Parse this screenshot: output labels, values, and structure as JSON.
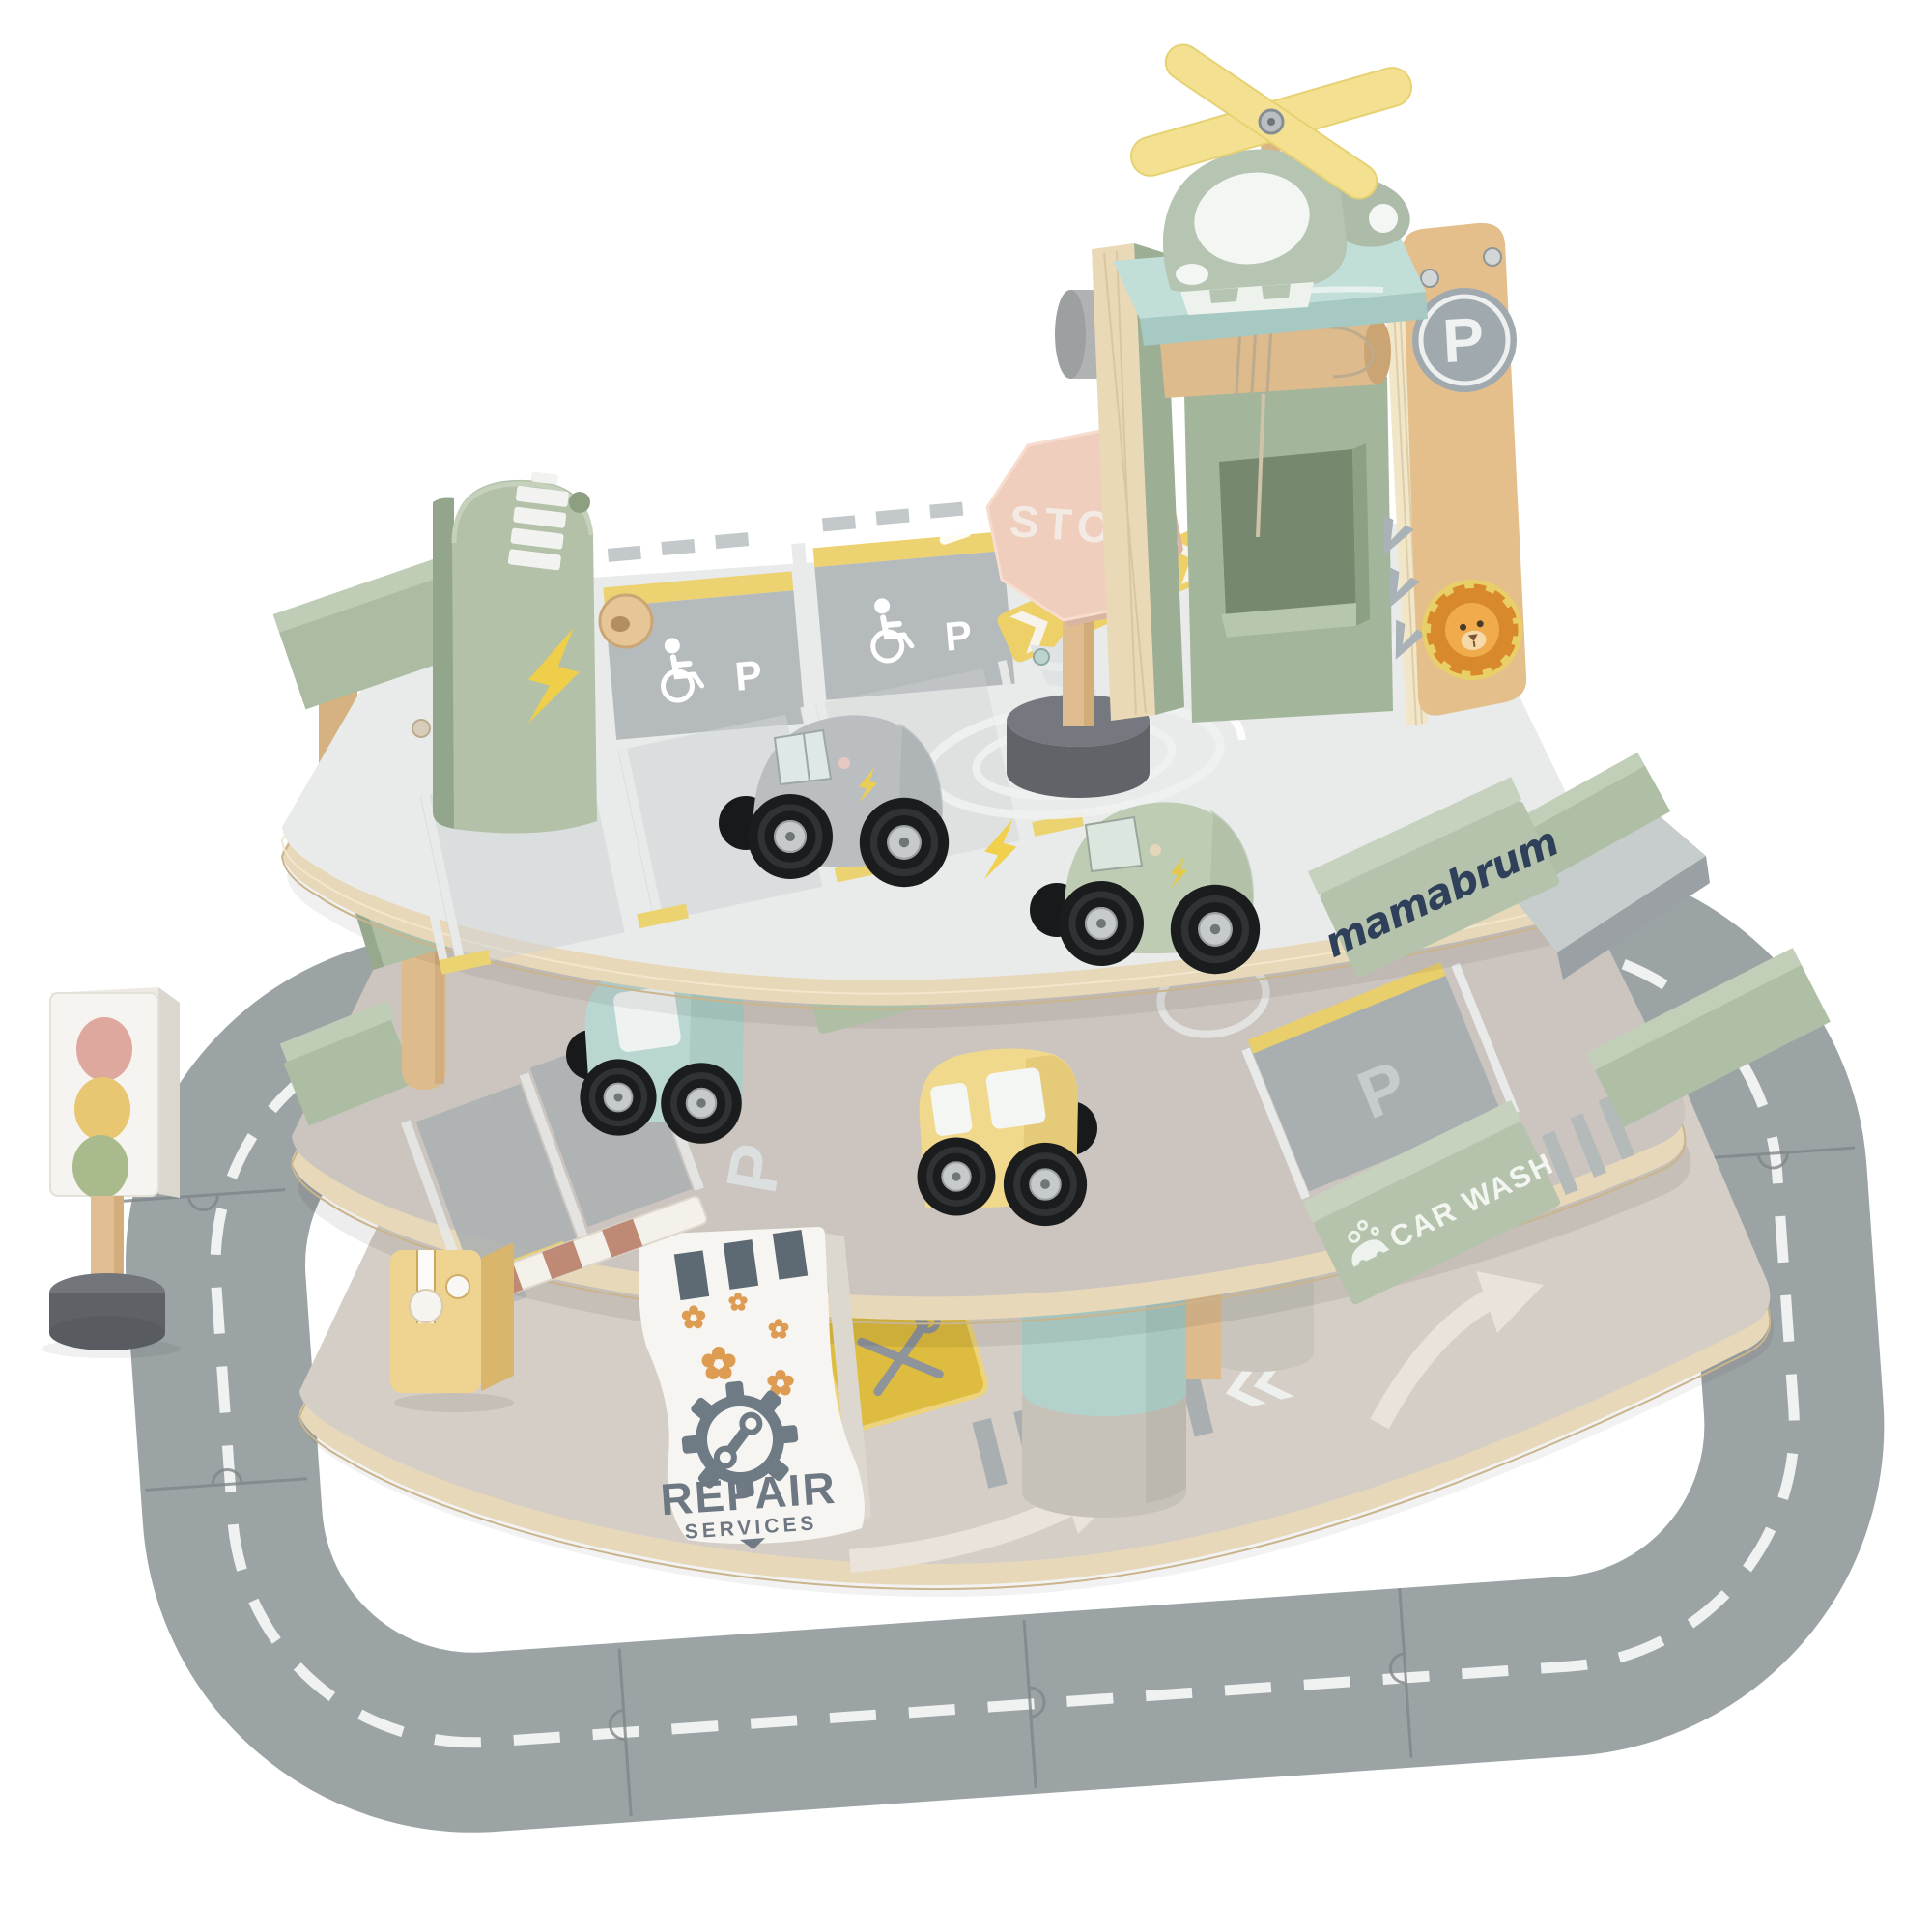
{
  "product": {
    "name": "Wooden multi-level toy parking garage playset",
    "brand": "mamabrum",
    "scene": "Product photo on plain white background"
  },
  "labels": {
    "brand_logo": "mamabrum",
    "stop_sign": "STOP",
    "car_wash_sign": "CAR WASH",
    "repair_sign_title": "REPAIR",
    "repair_sign_subtitle": "SERVICES",
    "tower_parking_badge": "P",
    "deck_bay_marking_left": "P",
    "deck_bay_marking_right": "P",
    "accessible_bay_1": "P",
    "accessible_bay_2": "P"
  },
  "colors": {
    "background": "#ffffff",
    "road_gray": "#9ca3a5",
    "top_deck_white": "#e9ebea",
    "middle_deck_gray": "#ccc5bf",
    "ground_beige": "#d5cec6",
    "plywood_edge": "#e7d8ba",
    "sage_green": "#aebfa5",
    "mint_blue": "#bcd9d4",
    "natural_wood": "#ddbb8d",
    "accent_yellow": "#ecd06a",
    "stop_sign_pink": "#f0cebd",
    "brand_navy": "#2f405a",
    "lion_orange": "#d8892b",
    "sign_graphics_gray": "#6e7a84",
    "wheel_black": "#1a1c1e"
  },
  "components": [
    "road-puzzle-ring",
    "ground-floor-plate",
    "middle-parking-deck",
    "top-parking-deck",
    "parking-tower-with-lift-winch",
    "rooftop-helipad",
    "helicopter-with-yellow-rotor",
    "stop-sign",
    "ev-charging-station",
    "accessible-parking-bays",
    "ev-parking-bays",
    "roundabout-marking",
    "gray-car",
    "green-car",
    "blue-car",
    "yellow-car",
    "car-wash-sign-block",
    "repair-services-sign",
    "boom-barrier",
    "traffic-light",
    "exit-ramp"
  ]
}
